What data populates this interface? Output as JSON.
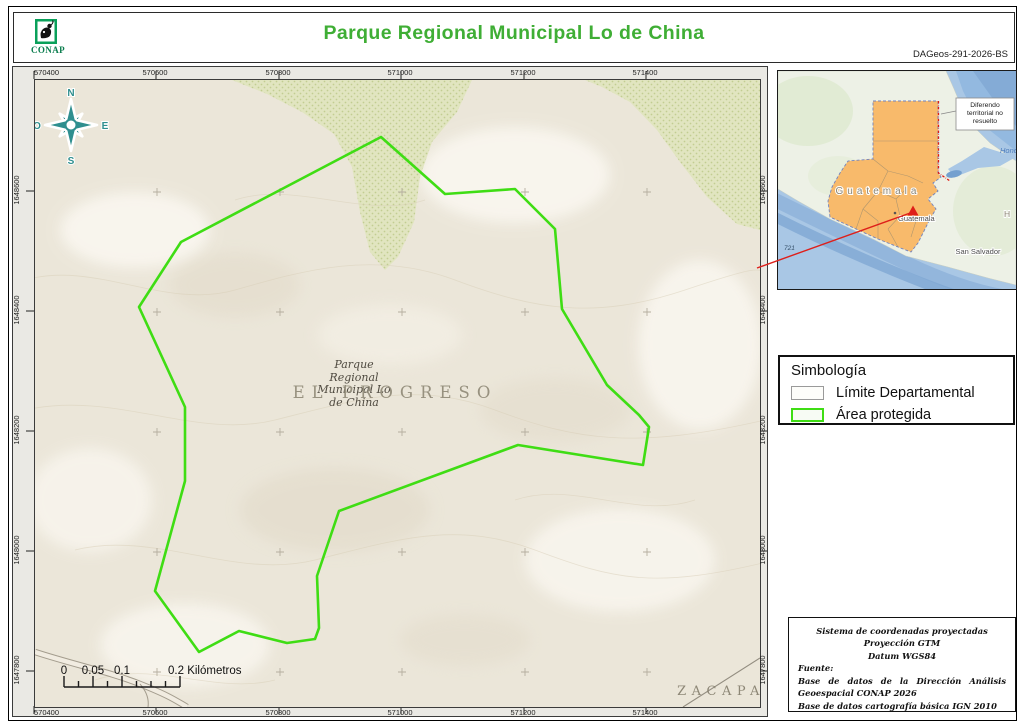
{
  "header": {
    "org": "CONAP",
    "title": "Parque Regional Municipal Lo de China",
    "code": "DAGeos-291-2026-BS"
  },
  "map": {
    "x_ticks": [
      "570400",
      "570600",
      "570800",
      "571000",
      "571200",
      "571400"
    ],
    "y_ticks": [
      "1648600",
      "1648400",
      "1648200",
      "1648000",
      "1647800"
    ],
    "compass": {
      "n": "N",
      "e": "E",
      "s": "S",
      "o": "O"
    },
    "park_label": {
      "line1": "Parque",
      "line2": "Regional",
      "line3": "Municipal Lo",
      "line4": "de China"
    },
    "department_label_center": "EL PROGRESO",
    "department_label_corner": "ZACAPA",
    "scalebar": {
      "t0": "0",
      "t1": "0.05",
      "t2": "0.1",
      "t3": "0.2",
      "unit": "Kilómetros"
    },
    "protected_area": {
      "color": "#3fdd14",
      "points": [
        [
          346,
          57
        ],
        [
          410,
          114
        ],
        [
          480,
          109
        ],
        [
          520,
          149
        ],
        [
          527,
          229
        ],
        [
          572,
          305
        ],
        [
          604,
          335
        ],
        [
          614,
          347
        ],
        [
          608,
          385
        ],
        [
          483,
          365
        ],
        [
          304,
          431
        ],
        [
          282,
          496
        ],
        [
          284,
          548
        ],
        [
          280,
          559
        ],
        [
          252,
          563
        ],
        [
          204,
          551
        ],
        [
          164,
          572
        ],
        [
          120,
          511
        ],
        [
          150,
          401
        ],
        [
          150,
          327
        ],
        [
          104,
          227
        ],
        [
          146,
          162
        ]
      ]
    }
  },
  "inset": {
    "country": "Guatemala",
    "city": "Guatemala",
    "city2": "San Salvador",
    "honduras_partial": "H o",
    "sea_partial": "Hond",
    "route": "721",
    "note_line1": "Diferendo",
    "note_line2": "territorial no",
    "note_line3": "resuelto"
  },
  "legend": {
    "title": "Simbología",
    "items": [
      {
        "label": "Límite Departamental",
        "swatch": "gray-outline"
      },
      {
        "label": "Área protegida",
        "swatch": "green-outline"
      }
    ]
  },
  "credits": {
    "line1": "Sistema de coordenadas proyectadas",
    "line2": "Proyección GTM",
    "line3": "Datum WGS84",
    "fuente": "Fuente:",
    "source1": "Base de datos de la Dirección Análisis Geoespacial CONAP 2026",
    "source2": "Base de datos cartografía básica IGN 2010"
  },
  "colors": {
    "title_green": "#3fae35",
    "protected_area_green": "#3fdd14",
    "compass_teal": "#2f8f8f",
    "guatemala_orange": "#f8ba6b",
    "vegetation": "#e1e5c0",
    "terrain_base": "#ebe6d9",
    "sea_blue": "#a9c7e5",
    "leader_red": "#de1f1a"
  }
}
